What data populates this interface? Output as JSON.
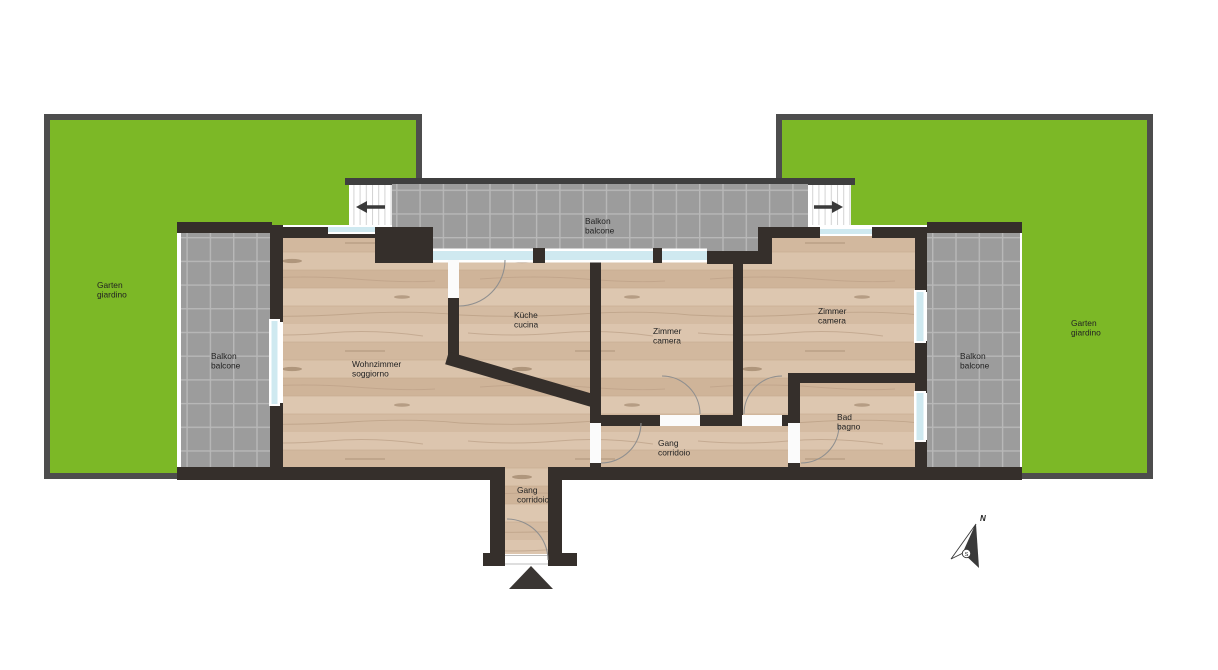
{
  "plan_title": "Apartment floor plan with gardens and balconies",
  "colors": {
    "garden_green": "#7cb826",
    "garden_border": "#4d4d4d",
    "tile_gray": "#9c9c9c",
    "tile_grid": "#b8b8b8",
    "wall_dark": "#352f2b",
    "wood_base": "#d7bfa7",
    "window_blue": "#cfe9f0"
  },
  "labels": {
    "garden_left": {
      "de": "Garten",
      "it": "giardino"
    },
    "garden_right": {
      "de": "Garten",
      "it": "giardino"
    },
    "balcony_top": {
      "de": "Balkon",
      "it": "balcone"
    },
    "balcony_left": {
      "de": "Balkon",
      "it": "balcone"
    },
    "balcony_right": {
      "de": "Balkon",
      "it": "balcone"
    },
    "living_room": {
      "de": "Wohnzimmer",
      "it": "soggiorno"
    },
    "kitchen": {
      "de": "Küche",
      "it": "cucina"
    },
    "bedroom_middle": {
      "de": "Zimmer",
      "it": "camera"
    },
    "bedroom_right": {
      "de": "Zimmer",
      "it": "camera"
    },
    "bathroom": {
      "de": "Bad",
      "it": "bagno"
    },
    "hallway": {
      "de": "Gang",
      "it": "corridoio"
    },
    "hallway_entry": {
      "de": "Gang",
      "it": "corridoio"
    }
  },
  "compass": {
    "north": "N",
    "south": "S"
  }
}
